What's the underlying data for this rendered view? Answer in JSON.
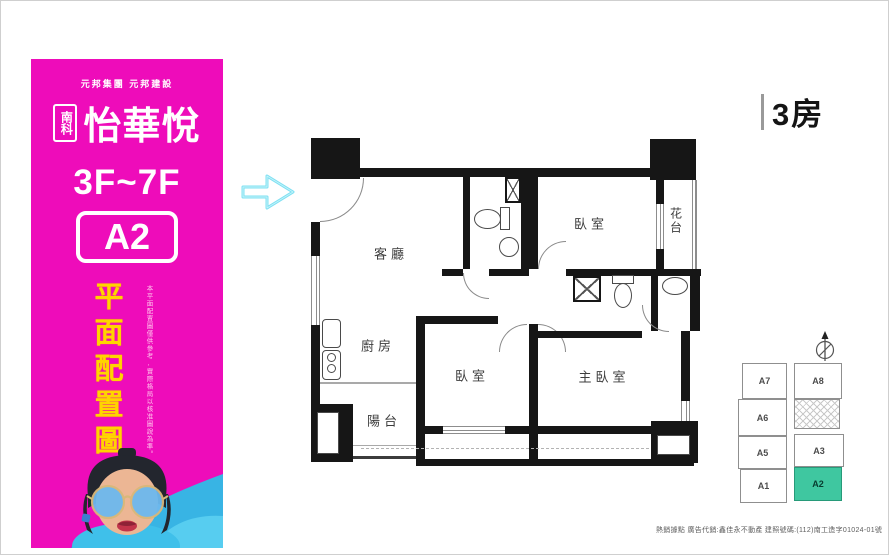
{
  "sidebar": {
    "bg_color": "#ee0cba",
    "accent_yellow": "#ffd400",
    "brand_small": "元邦集團 元邦建設",
    "brand_prefix": "南科",
    "brand_name": "怡華悅",
    "floors": "3F~7F",
    "unit": "A2",
    "vertical_title": "平面配置圖",
    "disclaimer_vertical": "本平面配置圖僅供參考,實際格局以核准圖說為準。"
  },
  "plan": {
    "badge": "3房",
    "entry_arrow_color": "#7ee0f2",
    "rooms": [
      {
        "id": "living",
        "label": "客廳"
      },
      {
        "id": "kitchen",
        "label": "廚房"
      },
      {
        "id": "bedroom1",
        "label": "臥室"
      },
      {
        "id": "bedroom2",
        "label": "臥室"
      },
      {
        "id": "master",
        "label": "主臥室"
      },
      {
        "id": "balcony",
        "label": "陽台"
      },
      {
        "id": "flower",
        "label": "花台"
      }
    ],
    "icons": {
      "entry": "arrow-right-icon",
      "compass": "north-arrow-icon"
    }
  },
  "keyplan": {
    "highlight_color": "#3fc7a0",
    "highlighted_unit": "A2",
    "units": [
      {
        "label": "A7"
      },
      {
        "label": "A8"
      },
      {
        "label": "A6"
      },
      {
        "label": "A5"
      },
      {
        "label": "A3"
      },
      {
        "label": "A1"
      },
      {
        "label": "A2"
      }
    ]
  },
  "footer": {
    "disclaimer": "熱銷據點 廣告代銷:鑫佳永不動產 建照號碼:(112)南工造字01024-01號"
  }
}
